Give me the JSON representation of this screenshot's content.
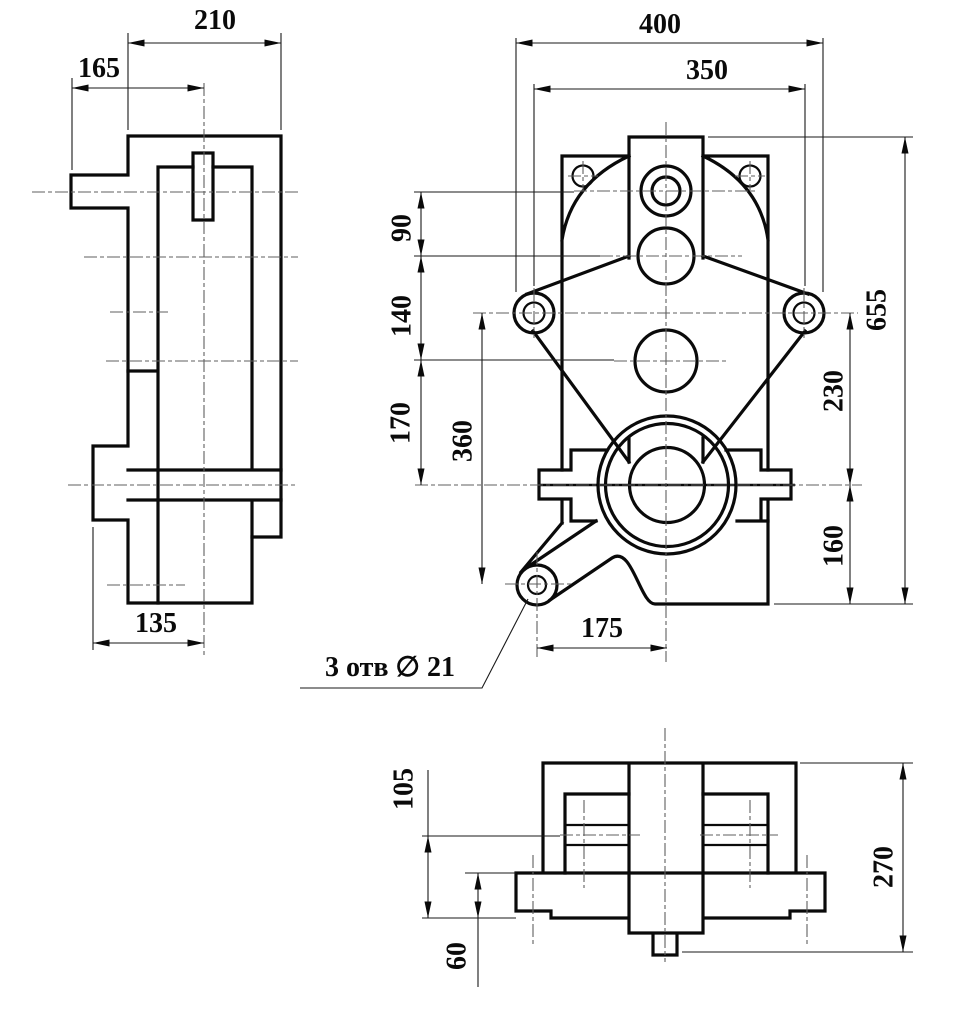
{
  "drawing": {
    "type": "engineering-orthographic-drawing",
    "views": {
      "side_view": {
        "dim_210": "210",
        "dim_165": "165",
        "dim_135": "135"
      },
      "front_view": {
        "dim_400": "400",
        "dim_350": "350",
        "dim_90": "90",
        "dim_140": "140",
        "dim_170": "170",
        "dim_360": "360",
        "dim_655": "655",
        "dim_230": "230",
        "dim_160": "160",
        "dim_175": "175",
        "holes_note": "3 отв ∅ 21"
      },
      "bottom_view": {
        "dim_105": "105",
        "dim_60": "60",
        "dim_270": "270"
      }
    },
    "colors": {
      "line": "#0a0a0a",
      "centerline": "#5f5f5f",
      "background": "#ffffff"
    }
  }
}
